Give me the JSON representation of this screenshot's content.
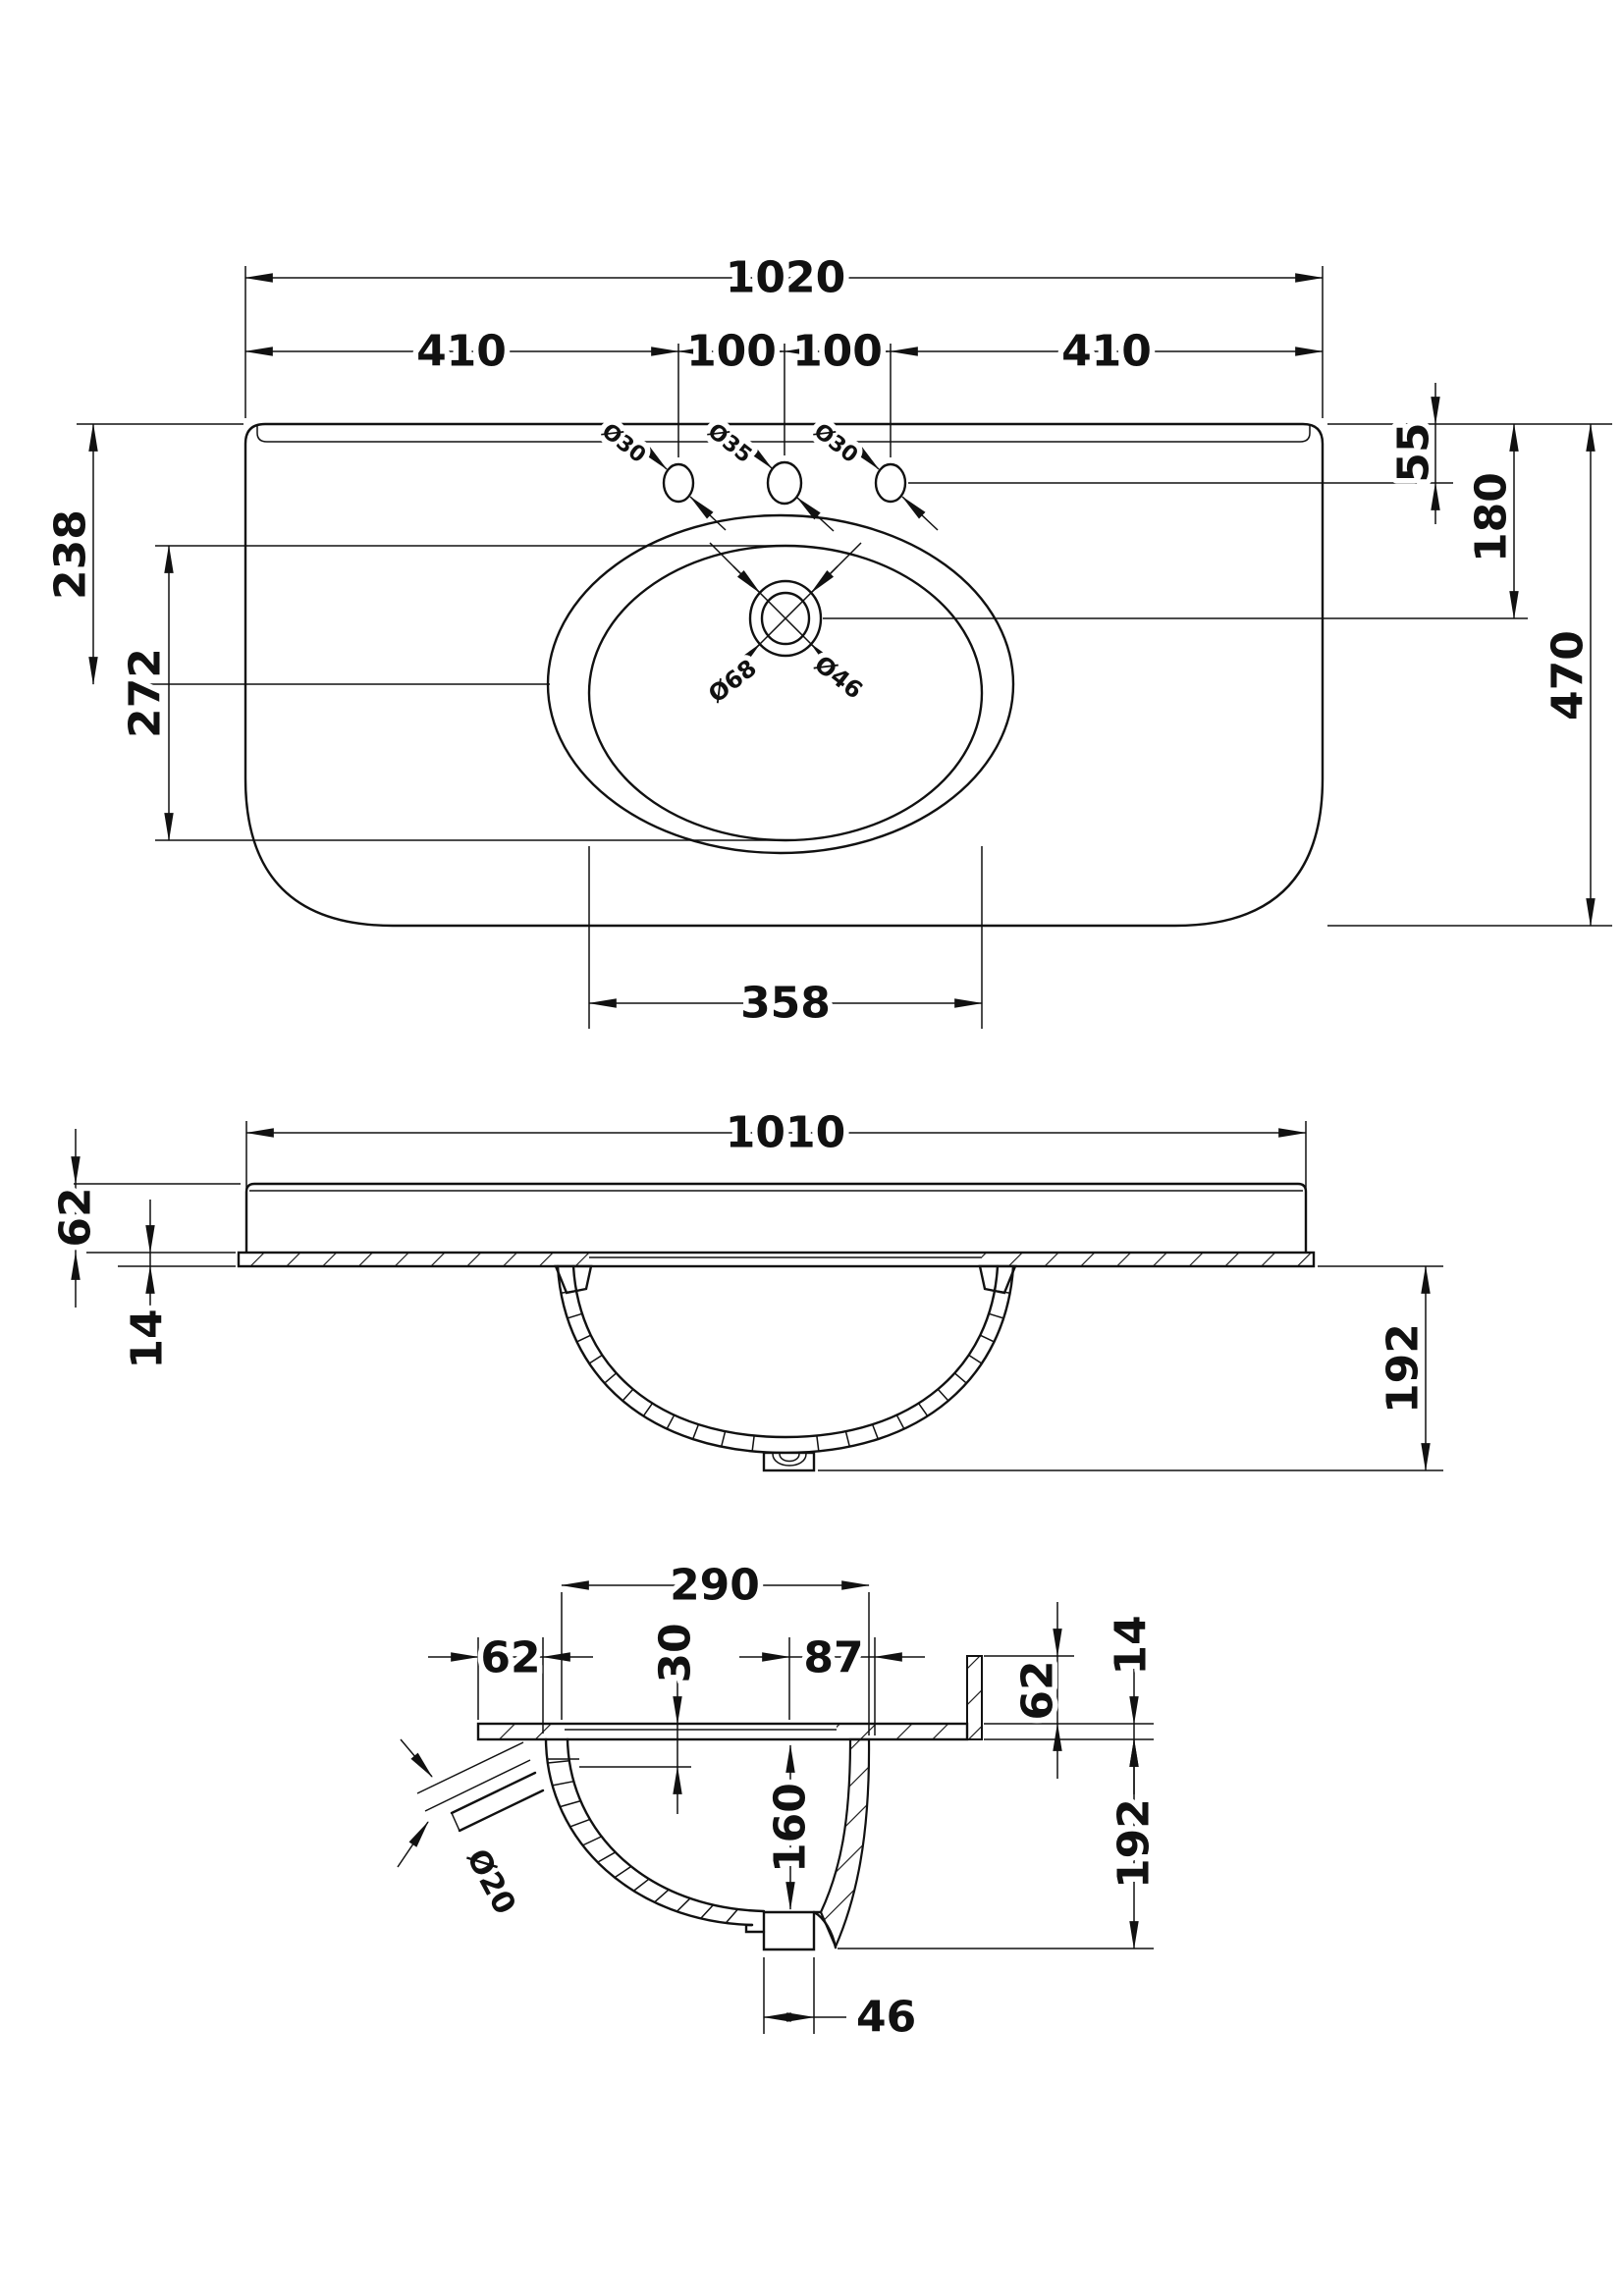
{
  "drawing": {
    "type": "technical-drawing",
    "subject": "curved-front basin with counter top, three tap holes - plan, front and side section views",
    "background_color": "#ffffff",
    "line_color": "#111111",
    "top_view": {
      "dims": {
        "overall_width": "1020",
        "left_edge_to_first_hole": "410",
        "hole_spacing_left": "100",
        "hole_spacing_right": "100",
        "last_hole_to_right_edge": "410",
        "back_edge_to_tap_holes": "55",
        "back_edge_to_drain": "180",
        "overall_depth": "470",
        "back_edge_to_bowl_centre": "238",
        "bowl_front_to_back": "272",
        "bowl_width": "358"
      },
      "labels": {
        "tap_hole_left": "Ø30",
        "tap_hole_centre": "Ø35",
        "tap_hole_right": "Ø30",
        "drain_outer": "Ø68",
        "drain_inner": "Ø46"
      }
    },
    "front_view": {
      "dims": {
        "overall_width": "1010",
        "upstand_height": "62",
        "counter_thickness": "14",
        "bowl_drop": "192"
      }
    },
    "side_view": {
      "dims": {
        "bowl_opening": "290",
        "front_overhang": "62",
        "rim_recess": "30",
        "drain_to_back": "87",
        "upstand_height": "62",
        "counter_thickness": "14",
        "bowl_inner_depth": "160",
        "bowl_drop": "192",
        "overflow_diameter": "Ø20",
        "waste_outlet_width": "46"
      }
    }
  }
}
